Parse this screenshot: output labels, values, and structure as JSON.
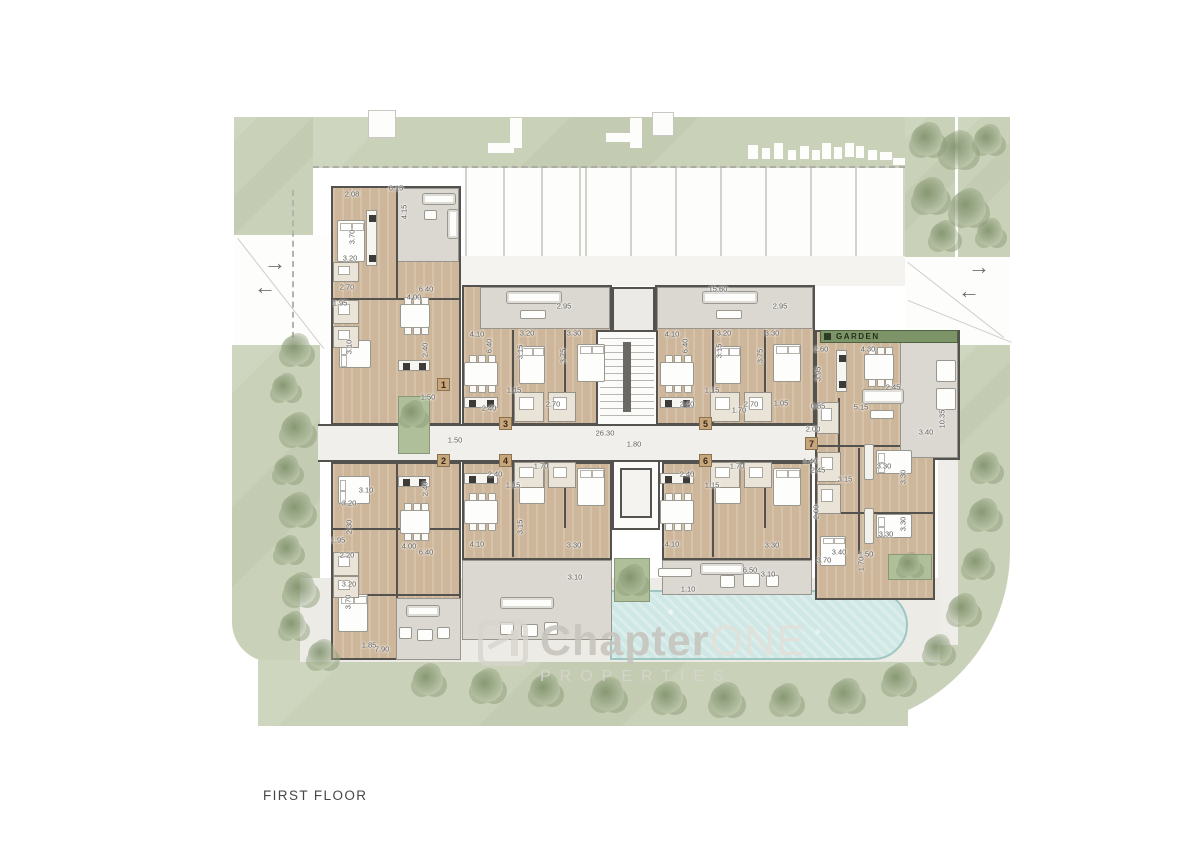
{
  "title": {
    "label": "FIRST FLOOR"
  },
  "watermark": {
    "brand_bold": "Chapter",
    "brand_accent": "ONE",
    "subtitle": "PROPERTIES"
  },
  "garden_label": "GARDEN",
  "colors": {
    "landscape_green": "#c9d1b8",
    "garden_bar_green": "#7c9468",
    "wood_floor": "#cdb69a",
    "terrace_gray": "#dbd8d2",
    "wall_dark": "#54524e",
    "pool_blue": "#cfe8e5",
    "path_gray": "#efede9",
    "tree_green": "#8fa07e",
    "dim_text": "#5f5d59",
    "badge_tan": "#c8a67b"
  },
  "unit_badges": [
    {
      "n": "1",
      "x": 437,
      "y": 378
    },
    {
      "n": "2",
      "x": 437,
      "y": 454
    },
    {
      "n": "3",
      "x": 499,
      "y": 417
    },
    {
      "n": "4",
      "x": 499,
      "y": 454
    },
    {
      "n": "5",
      "x": 699,
      "y": 417
    },
    {
      "n": "6",
      "x": 699,
      "y": 454
    },
    {
      "n": "7",
      "x": 805,
      "y": 437
    }
  ],
  "entry_arrows": [
    {
      "dir": "right",
      "glyph": "→",
      "x": 264,
      "y": 252
    },
    {
      "dir": "left",
      "glyph": "←",
      "x": 254,
      "y": 276
    },
    {
      "dir": "right",
      "glyph": "→",
      "x": 968,
      "y": 256
    },
    {
      "dir": "left",
      "glyph": "←",
      "x": 958,
      "y": 280
    }
  ],
  "dimensions": [
    {
      "t": "2.08",
      "x": 352,
      "y": 194,
      "v": 0
    },
    {
      "t": "6.15",
      "x": 396,
      "y": 188,
      "v": 0
    },
    {
      "t": "4.15",
      "x": 404,
      "y": 212,
      "v": 1
    },
    {
      "t": "3.70",
      "x": 352,
      "y": 237,
      "v": 1
    },
    {
      "t": "3.20",
      "x": 350,
      "y": 258,
      "v": 0
    },
    {
      "t": "2.70",
      "x": 347,
      "y": 287,
      "v": 0
    },
    {
      "t": "6.40",
      "x": 426,
      "y": 289,
      "v": 0
    },
    {
      "t": "1.95",
      "x": 340,
      "y": 303,
      "v": 0
    },
    {
      "t": "4.00",
      "x": 414,
      "y": 297,
      "v": 0
    },
    {
      "t": "3.10",
      "x": 349,
      "y": 347,
      "v": 1
    },
    {
      "t": "2.40",
      "x": 425,
      "y": 350,
      "v": 1
    },
    {
      "t": "1.50",
      "x": 428,
      "y": 397,
      "v": 0
    },
    {
      "t": "1.50",
      "x": 455,
      "y": 440,
      "v": 0
    },
    {
      "t": "26.30",
      "x": 605,
      "y": 433,
      "v": 0
    },
    {
      "t": "1.80",
      "x": 634,
      "y": 444,
      "v": 0
    },
    {
      "t": "2.95",
      "x": 564,
      "y": 306,
      "v": 0
    },
    {
      "t": "4.10",
      "x": 477,
      "y": 334,
      "v": 0
    },
    {
      "t": "6.40",
      "x": 489,
      "y": 346,
      "v": 1
    },
    {
      "t": "3.20",
      "x": 527,
      "y": 333,
      "v": 0
    },
    {
      "t": "3.30",
      "x": 574,
      "y": 333,
      "v": 0
    },
    {
      "t": "3.15",
      "x": 520,
      "y": 352,
      "v": 1
    },
    {
      "t": "3.75",
      "x": 563,
      "y": 356,
      "v": 1
    },
    {
      "t": "1.15",
      "x": 514,
      "y": 390,
      "v": 0
    },
    {
      "t": "2.40",
      "x": 489,
      "y": 408,
      "v": 0
    },
    {
      "t": "2.70",
      "x": 553,
      "y": 404,
      "v": 0
    },
    {
      "t": "15.60",
      "x": 718,
      "y": 289,
      "v": 0
    },
    {
      "t": "2.95",
      "x": 780,
      "y": 306,
      "v": 0
    },
    {
      "t": "4.10",
      "x": 672,
      "y": 334,
      "v": 0
    },
    {
      "t": "6.40",
      "x": 685,
      "y": 346,
      "v": 1
    },
    {
      "t": "3.20",
      "x": 724,
      "y": 333,
      "v": 0
    },
    {
      "t": "3.30",
      "x": 772,
      "y": 333,
      "v": 0
    },
    {
      "t": "3.15",
      "x": 719,
      "y": 351,
      "v": 1
    },
    {
      "t": "3.75",
      "x": 760,
      "y": 356,
      "v": 1
    },
    {
      "t": "1.15",
      "x": 712,
      "y": 390,
      "v": 0
    },
    {
      "t": "2.40",
      "x": 687,
      "y": 404,
      "v": 0
    },
    {
      "t": "1.70",
      "x": 739,
      "y": 410,
      "v": 0
    },
    {
      "t": "2.70",
      "x": 751,
      "y": 404,
      "v": 0
    },
    {
      "t": "1.05",
      "x": 781,
      "y": 403,
      "v": 0
    },
    {
      "t": "2.60",
      "x": 821,
      "y": 349,
      "v": 0
    },
    {
      "t": "4.30",
      "x": 868,
      "y": 349,
      "v": 0
    },
    {
      "t": "3.95",
      "x": 818,
      "y": 374,
      "v": 1
    },
    {
      "t": "2.45",
      "x": 893,
      "y": 387,
      "v": 0
    },
    {
      "t": "5.15",
      "x": 861,
      "y": 407,
      "v": 0
    },
    {
      "t": "0.85",
      "x": 818,
      "y": 406,
      "v": 0
    },
    {
      "t": "2.00",
      "x": 813,
      "y": 429,
      "v": 0
    },
    {
      "t": "10.35",
      "x": 942,
      "y": 419,
      "v": 1
    },
    {
      "t": "3.40",
      "x": 926,
      "y": 432,
      "v": 0
    },
    {
      "t": "1.40",
      "x": 810,
      "y": 461,
      "v": 0
    },
    {
      "t": "2.45",
      "x": 818,
      "y": 470,
      "v": 0
    },
    {
      "t": "3.15",
      "x": 845,
      "y": 479,
      "v": 0
    },
    {
      "t": "3.30",
      "x": 884,
      "y": 466,
      "v": 0
    },
    {
      "t": "3.30",
      "x": 903,
      "y": 477,
      "v": 1
    },
    {
      "t": "2.00",
      "x": 816,
      "y": 512,
      "v": 1
    },
    {
      "t": "3.30",
      "x": 903,
      "y": 524,
      "v": 1
    },
    {
      "t": "3.30",
      "x": 886,
      "y": 534,
      "v": 0
    },
    {
      "t": "3.40",
      "x": 839,
      "y": 552,
      "v": 0
    },
    {
      "t": "3.70",
      "x": 824,
      "y": 560,
      "v": 0
    },
    {
      "t": "1.50",
      "x": 866,
      "y": 554,
      "v": 0
    },
    {
      "t": "1.70",
      "x": 861,
      "y": 564,
      "v": 1
    },
    {
      "t": "2.40",
      "x": 425,
      "y": 489,
      "v": 1
    },
    {
      "t": "3.10",
      "x": 366,
      "y": 490,
      "v": 0
    },
    {
      "t": "3.20",
      "x": 349,
      "y": 503,
      "v": 0
    },
    {
      "t": "2.30",
      "x": 349,
      "y": 527,
      "v": 1
    },
    {
      "t": "1.95",
      "x": 338,
      "y": 540,
      "v": 0
    },
    {
      "t": "2.20",
      "x": 347,
      "y": 555,
      "v": 0
    },
    {
      "t": "4.00",
      "x": 409,
      "y": 546,
      "v": 0
    },
    {
      "t": "6.40",
      "x": 426,
      "y": 552,
      "v": 0
    },
    {
      "t": "2.40",
      "x": 495,
      "y": 474,
      "v": 0
    },
    {
      "t": "1.70",
      "x": 541,
      "y": 466,
      "v": 0
    },
    {
      "t": "1.15",
      "x": 513,
      "y": 485,
      "v": 0
    },
    {
      "t": "4.10",
      "x": 477,
      "y": 544,
      "v": 0
    },
    {
      "t": "3.30",
      "x": 574,
      "y": 545,
      "v": 0
    },
    {
      "t": "3.15",
      "x": 520,
      "y": 527,
      "v": 1
    },
    {
      "t": "2.40",
      "x": 687,
      "y": 474,
      "v": 0
    },
    {
      "t": "1.70",
      "x": 737,
      "y": 466,
      "v": 0
    },
    {
      "t": "1.15",
      "x": 712,
      "y": 485,
      "v": 0
    },
    {
      "t": "4.10",
      "x": 672,
      "y": 544,
      "v": 0
    },
    {
      "t": "3.30",
      "x": 772,
      "y": 545,
      "v": 0
    },
    {
      "t": "3.20",
      "x": 349,
      "y": 584,
      "v": 0
    },
    {
      "t": "3.70",
      "x": 348,
      "y": 602,
      "v": 1
    },
    {
      "t": "1.85",
      "x": 369,
      "y": 645,
      "v": 0
    },
    {
      "t": "7.90",
      "x": 382,
      "y": 649,
      "v": 0
    },
    {
      "t": "6.50",
      "x": 750,
      "y": 570,
      "v": 0
    },
    {
      "t": "3.10",
      "x": 768,
      "y": 574,
      "v": 0
    },
    {
      "t": "1.10",
      "x": 688,
      "y": 589,
      "v": 0
    },
    {
      "t": "3.10",
      "x": 575,
      "y": 577,
      "v": 0
    }
  ]
}
